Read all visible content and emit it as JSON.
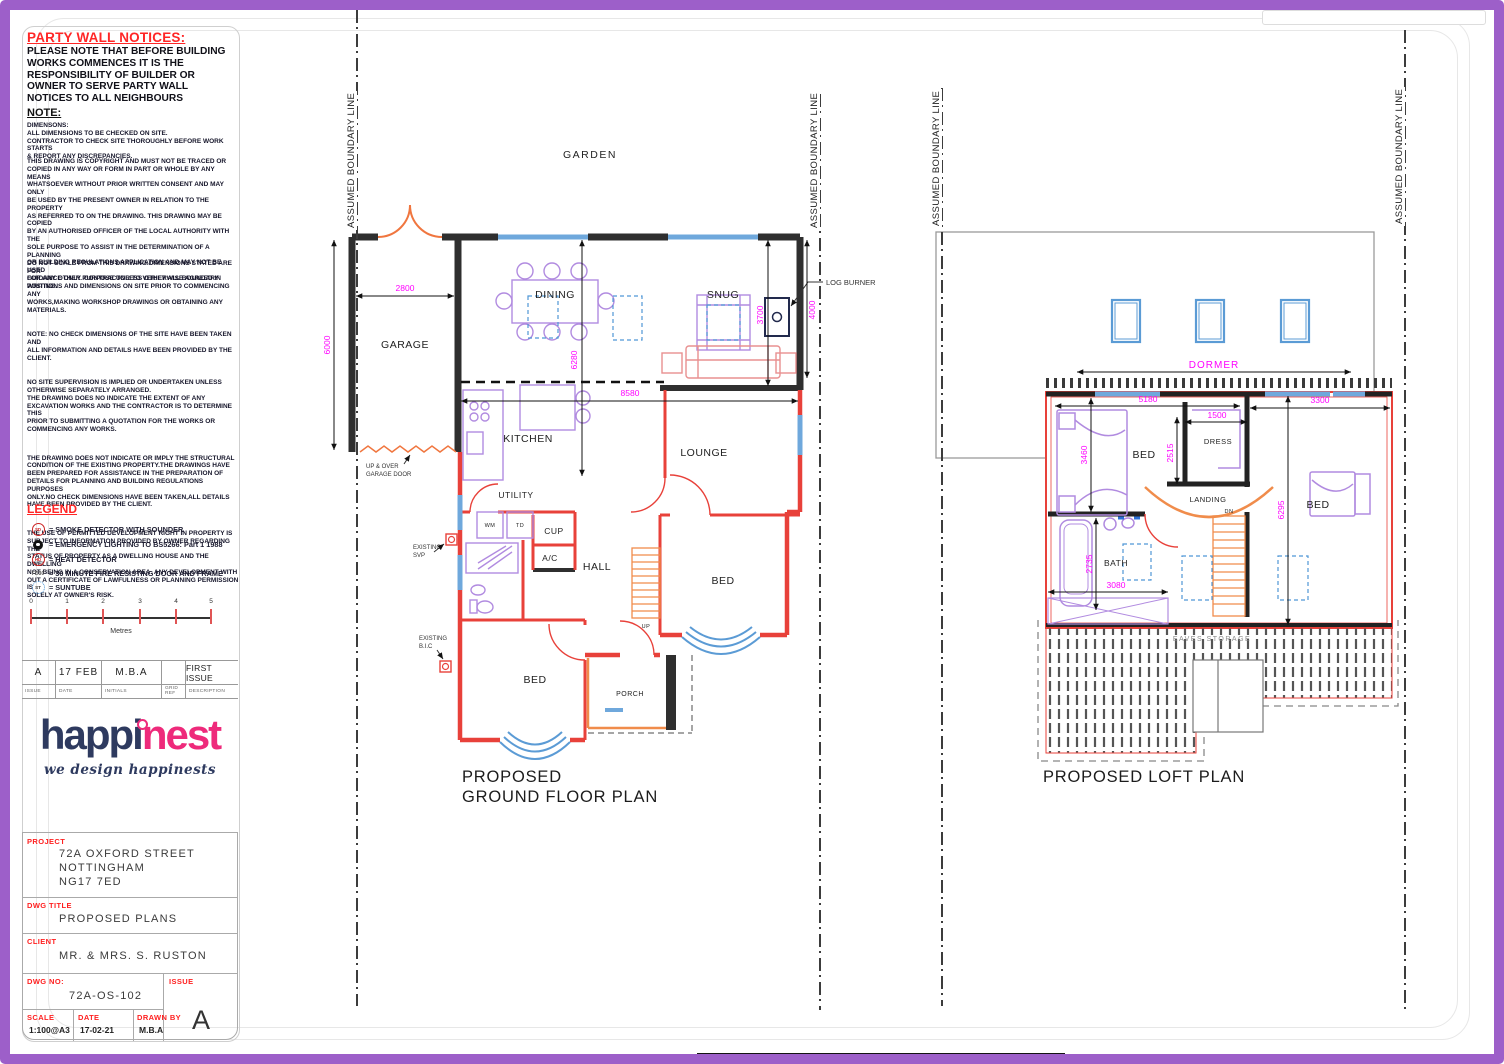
{
  "colors": {
    "frame": "#9d5fc9",
    "label_red": "#ff2020",
    "dim_magenta": "#ff00ff",
    "wall_red": "#e8413a",
    "window_blue": "#6fa8dc",
    "stair_orange": "#f08c4b",
    "furniture_purple": "#b18be0",
    "logo_navy": "#2e3a5f",
    "logo_pink": "#ee2a7b"
  },
  "party_wall": {
    "title": "PARTY WALL NOTICES:",
    "body": "PLEASE NOTE THAT BEFORE BUILDING\nWORKS COMMENCES IT IS THE\nRESPONSIBILITY OF BUILDER OR\nOWNER TO SERVE PARTY WALL\nNOTICES TO ALL NEIGHBOURS"
  },
  "note": {
    "heading": "NOTE:",
    "lines": "DIMENSONS:\nALL DIMENSIONS TO BE CHECKED ON SITE.\nCONTRACTOR TO CHECK SITE THOROUGHLY BEFORE WORK STARTS\n& REPORT ANY DISCREPANCIES.",
    "copyright": "THIS DRAWING IS COPYRIGHT AND MUST NOT BE TRACED OR\nCOPIED IN ANY WAY OR FORM IN PART OR WHOLE BY ANY MEANS\nWHATSOEVER WITHOUT PRIOR WRITTEN CONSENT AND MAY ONLY\nBE USED BY THE PRESENT OWNER IN RELATION TO THE PROPERTY\nAS REFERRED TO ON THE DRAWING. THIS DRAWING MAY BE COPIED\nBY AN AUTHORISED OFFICER OF THE LOCAL AUTHORITY WITH THE\nSOLE PURPOSE TO ASSIST IN THE DETERMINATION OF A PLANNING\nOR BUILDING REGULATIONS APPLICATION AND MAY NOT BE USED\nFOR ANY OTHER PURPOSE UNLESS OTHERWISE AGREED IN\nWRITING."
  },
  "disclaimers": [
    "DO NOT SCALE FROM THIS DRAWING.DIMENSIONS STATED ARE FOR\nGUIDANCE ONLY. CONTRACTOR TO VERIFY ALL BOUNDARY\nPOSITIONS AND DIMENSIONS ON SITE PRIOR TO COMMENCING ANY\nWORKS,MAKING WORKSHOP DRAWINGS OR OBTAINING ANY\nMATERIALS.",
    "NOTE: NO CHECK DIMENSIONS OF THE SITE HAVE BEEN TAKEN AND\nALL INFORMATION AND DETAILS HAVE BEEN PROVIDED BY THE\nCLIENT.",
    "NO SITE SUPERVISION IS IMPLIED OR UNDERTAKEN UNLESS\nOTHERWISE SEPARATELY ARRANGED.\nTHE DRAWING DOES NO INDICATE THE EXTENT OF ANY\nEXCAVATION WORKS AND THE CONTRACTOR IS TO DETERMINE THIS\nPRIOR TO SUBMITTING A QUOTATION FOR THE WORKS OR\nCOMMENCING ANY WORKS.",
    "THE DRAWING DOES NOT INDICATE OR IMPLY THE STRUCTURAL\nCONDITION OF THE EXISTING PROPERTY.THE DRAWINGS HAVE\nBEEN PREPARED FOR ASSISTANCE IN THE PREPARATION OF\nDETAILS FOR  PLANNING AND BUILDING REGULATIONS PURPOSES\nONLY.NO CHECK DIMENSIONS HAVE BEEN  TAKEN,ALL DETAILS\nHAVE BEEN PROVIDED BY THE CLIENT.",
    "THE USE OF PERMITTED DEVELOPMENT RIGHT IN PROPERTY IS\nSUBJECT TO INFORMATION PROVIDED BY OWNER  REGARDING THE\nSTATUS OF PROPERTY AS A DWELLING HOUSE AND THE DWELLING\nNOT BEING IN A CONSERVATION AREA. ANY DEVELOPMENT WITH\nOUT A CERTIFICATE OF LAWFULNESS OR PLANNING PERMISSION IS\nSOLELY AT OWNER'S RISK."
  ],
  "legend": {
    "title": "LEGEND",
    "items": [
      {
        "symbol": "SD",
        "label": "= SMOKE DETECTOR WITH SOUNDER"
      },
      {
        "symbol": "",
        "label": "= EMERGENCY LIGHTING TO BS5266: Part 1 1988"
      },
      {
        "symbol": "HD",
        "label": "= HEAT DETECTOR"
      },
      {
        "symbol": "FD30",
        "label": "= 30 MINUTE FIRE RESISTING DOOR AND FRAME"
      },
      {
        "symbol": "ST",
        "label": "= SUNTUBE"
      }
    ]
  },
  "scale_bar": {
    "ticks": [
      "0",
      "1",
      "2",
      "3",
      "4",
      "5"
    ],
    "unit": "Metres"
  },
  "issue_table": {
    "headers": [
      "ISSUE",
      "DATE",
      "INITIALS",
      "GRID REF",
      "DESCRIPTION"
    ],
    "row": [
      "A",
      "17 FEB",
      "M.B.A",
      "",
      "FIRST ISSUE"
    ]
  },
  "logo": {
    "part1": "happi",
    "part2": "nest",
    "tagline": "we design happinests"
  },
  "title_block": {
    "project_label": "PROJECT",
    "project": "72A OXFORD STREET\nNOTTINGHAM\nNG17 7ED",
    "dwg_title_label": "DWG TITLE",
    "dwg_title": "PROPOSED PLANS",
    "client_label": "CLIENT",
    "client": "MR. & MRS. S. RUSTON",
    "dwg_no_label": "DWG NO:",
    "dwg_no": "72A-OS-102",
    "issue_label": "ISSUE",
    "issue": "A",
    "scale_label": "SCALE",
    "scale": "1:100@A3",
    "date_label": "DATE",
    "date": "17-02-21",
    "drawn_label": "DRAWN BY",
    "drawn_by": "M.B.A"
  },
  "site": {
    "boundary_label": "ASSUMED BOUNDARY LINE",
    "garden": "GARDEN"
  },
  "ground_floor": {
    "title_line1": "PROPOSED",
    "title_line2": "GROUND FLOOR PLAN",
    "rooms": {
      "garage": "GARAGE",
      "dining": "DINING",
      "snug": "SNUG",
      "kitchen": "KITCHEN",
      "utility": "UTILITY",
      "cup": "CUP",
      "ac": "A/C",
      "hall": "HALL",
      "lounge": "LOUNGE",
      "bed_rear": "BED",
      "bed_front": "BED",
      "porch": "PORCH",
      "wm": "WM",
      "td": "TD"
    },
    "stairs_label": "UP",
    "dims": {
      "garage_width": "2800",
      "garage_depth": "6000",
      "rear_width": "8580",
      "kitchen_depth": "6280",
      "snug_depth": "3700",
      "snug_ext": "4000"
    },
    "notes": {
      "log_burner": "LOG BURNER",
      "garage_door1": "UP & OVER",
      "garage_door2": "GARAGE DOOR",
      "svp1": "EXISTING",
      "svp2": "SVP",
      "bic1": "EXISTING",
      "bic2": "B.I.C"
    }
  },
  "loft": {
    "title": "PROPOSED LOFT PLAN",
    "dormer": "DORMER",
    "rooms": {
      "bed_left": "BED",
      "bed_right": "BED",
      "dress": "DRESS",
      "landing": "LANDING",
      "bath": "BATH"
    },
    "stairs_label": "DN",
    "eaves": "EAVES STORAGE",
    "dims": {
      "d5180": "5180",
      "d1500": "1500",
      "d2515": "2515",
      "d3300": "3300",
      "d3460": "3460",
      "d6295": "6295",
      "d2735": "2735",
      "d3080": "3080"
    }
  }
}
